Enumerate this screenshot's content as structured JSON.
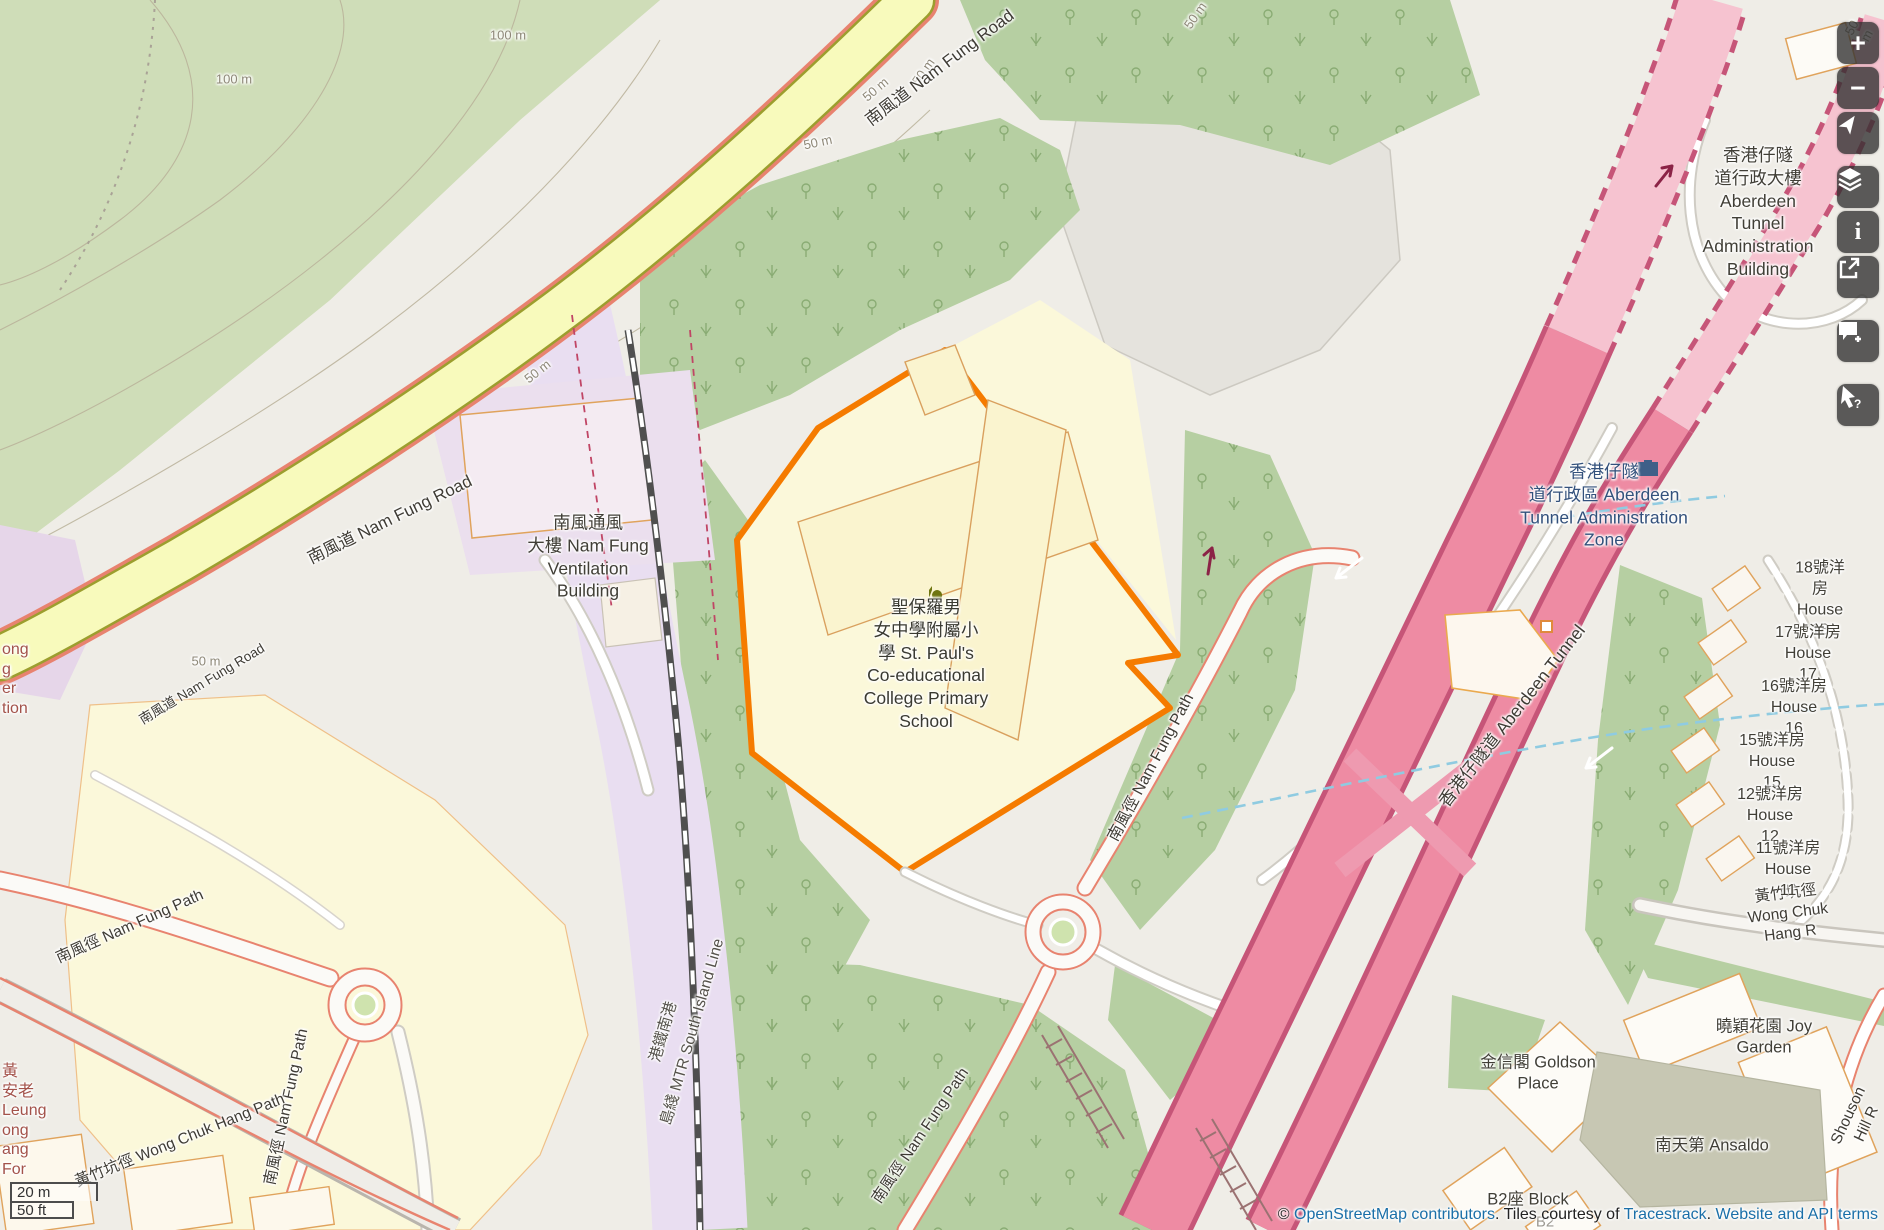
{
  "colors": {
    "highlight_orange": "#f57b00",
    "road_yellow": "#f8fabc",
    "road_pink": "#ee8ba3",
    "forest_green": "#b6cfa2",
    "rail_lavender": "#e9def1",
    "stream_blue": "#8fcbe1",
    "link_blue": "#1a6fa8",
    "control_bg": "#303030"
  },
  "controls": {
    "zoom_in": "+",
    "zoom_out": "−",
    "info": "i",
    "query_mark": "?"
  },
  "scalebar": {
    "metric": "20 m",
    "imperial": "50 ft"
  },
  "attribution": {
    "copyright_prefix": "© ",
    "osm_link": "OpenStreetMap contributors",
    "middle": ". Tiles courtesy of ",
    "tracestrack_link": "Tracestrack",
    "separator": ". ",
    "terms_link": "Website and API terms"
  },
  "labels": {
    "c100a": "100 m",
    "c100b": "100 m",
    "c50a": "50 m",
    "c50b": "50 m",
    "c50c": "50 m",
    "c50d": "50 m",
    "c50e": "50 m",
    "c50f": "50 m",
    "c50g": "50 m",
    "nfr_a": "南風道 Nam Fung Road",
    "nfr_b": "南風道 Nam Fung Road",
    "nfr_c": "南風道 Nam Fung Road",
    "nfp_a": "南風徑 Nam Fung Path",
    "nfp_b": "南風徑 Nam Fung Path",
    "nfp_c": "南風徑 Nam Fung Path",
    "nfp_d": "南風徑 Nam Fung Path",
    "wch_left": "黃竹坑徑 Wong Chuk Hang Path",
    "wch_right": "黃竹坑徑 Wong Chuk Hang R",
    "aberdeen_tunnel": "香港仔隧道 Aberdeen Tunnel",
    "mtr_a": "港鐵南港",
    "mtr_b": "島綫 MTR South Island Line",
    "shouson": "Shouson Hill R",
    "school": "聖保羅男\n女中學附屬小\n學 St. Paul's\nCo-educational\nCollege Primary\nSchool",
    "ventilation": "南風通風\n大樓 Nam Fung\nVentilation\nBuilding",
    "admin_building": "香港仔隧\n道行政大樓\nAberdeen Tunnel\nAdministration\nBuilding",
    "admin_zone": "香港仔隧\n道行政區 Aberdeen\nTunnel Administration\nZone",
    "house18": "18號洋房 House\n18",
    "house17": "17號洋房 House\n17",
    "house16": "16號洋房 House\n16",
    "house15": "15號洋房 House\n15",
    "house12": "12號洋房 House\n12",
    "house11": "11號洋房 House\n11",
    "goldson": "金信閣 Goldson\nPlace",
    "joy_garden": "曉穎花園 Joy\nGarden",
    "ansaldo": "南天第 Ansaldo",
    "b2_block": "B2座 Block",
    "b2_faint": "B2",
    "cut_left_a": "黃\n安老\nLeung\nong\nang\nFor",
    "cut_left_b": "ong\ng\ner\ntion"
  }
}
